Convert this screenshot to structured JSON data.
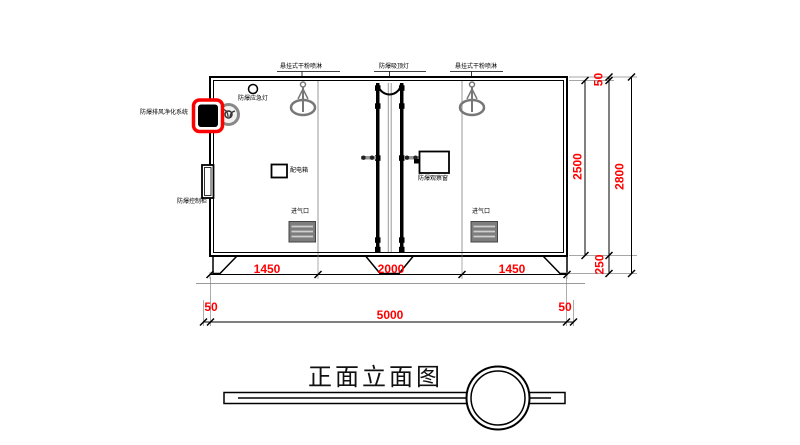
{
  "title": "正面立面图",
  "equipment": {
    "sprinkler_left": "悬挂式干粉喷淋",
    "ceiling_light": "防爆吸顶灯",
    "sprinkler_right": "悬挂式干粉喷淋",
    "emergency_light": "防爆应急灯",
    "exhaust_purifier": "防爆排风净化系统",
    "control_cabinet": "防爆控制柜",
    "power_box": "配电箱",
    "observation_window": "防爆观察窗",
    "air_inlet_left": "进气口",
    "air_inlet_right": "进气口"
  },
  "dimensions": {
    "seg_left": "1450",
    "seg_mid": "2000",
    "seg_right": "1450",
    "margin_left": "50",
    "total_width": "5000",
    "margin_right": "50",
    "inner_height": "2500",
    "roof_thickness": "50",
    "total_height": "2800",
    "base_height": "250"
  },
  "colors": {
    "dimension_text": "#ff0000",
    "highlight_box": "#ff0000",
    "linework": "#000000",
    "device_gray": "#777777"
  }
}
